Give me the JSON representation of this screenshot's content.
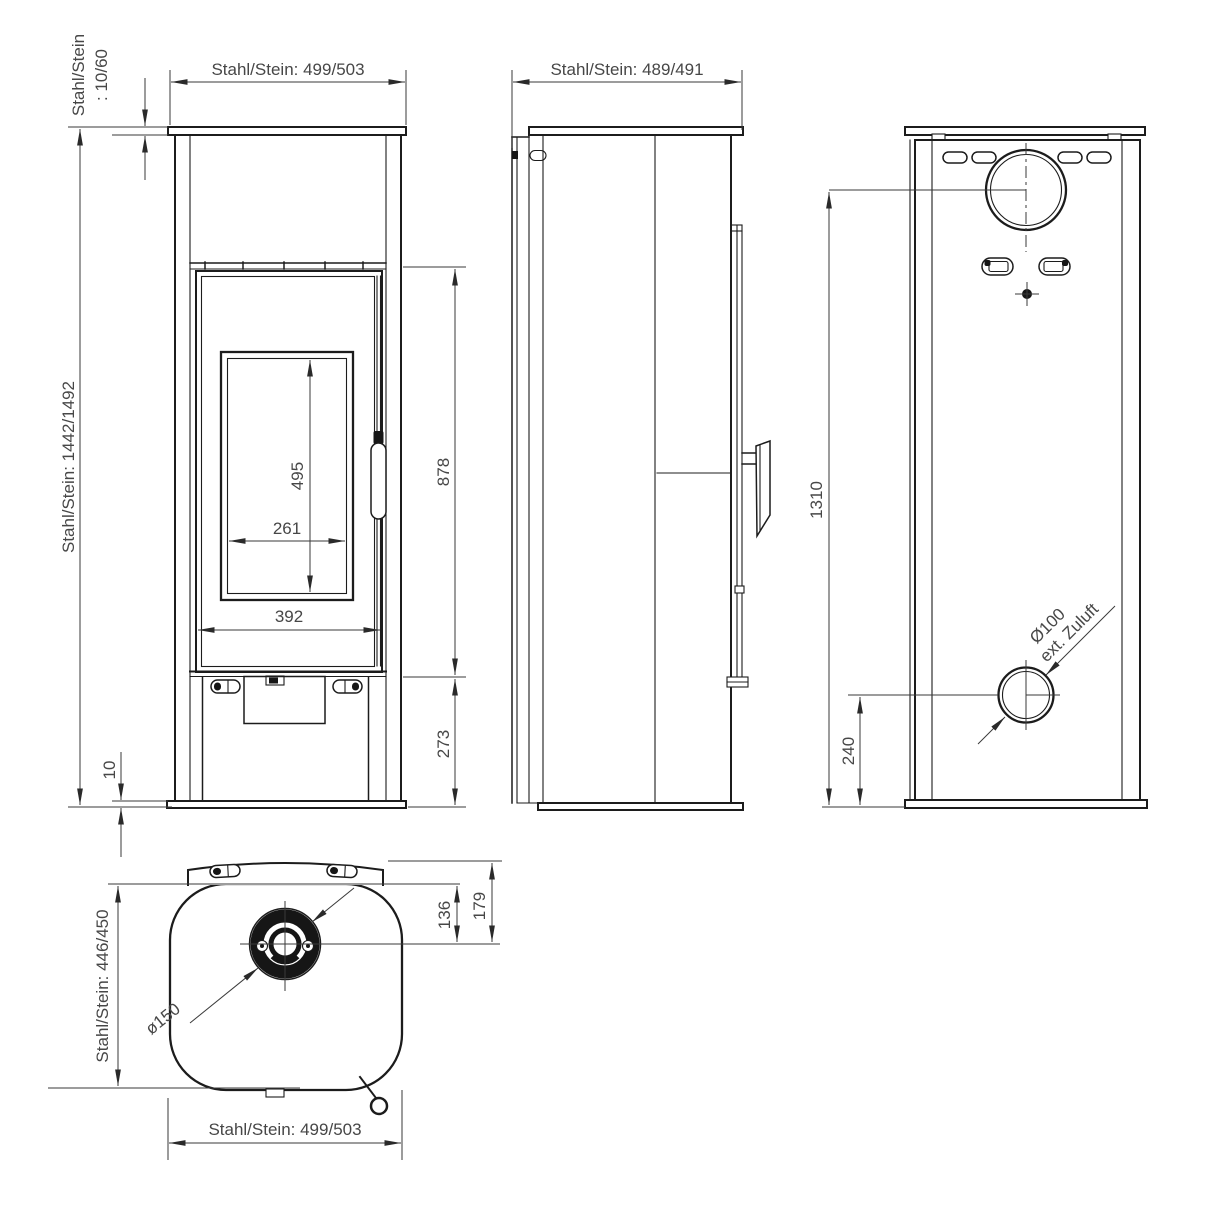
{
  "drawing": {
    "type": "technical-dimension-drawing",
    "subject": "wood stove (Kaminofen) four views",
    "colors": {
      "line": "#1c1c1c",
      "text": "#474747",
      "background": "#ffffff"
    },
    "views": {
      "front": {
        "width_label": "Stahl/Stein: 499/503",
        "height_label": "Stahl/Stein: 1442/1492",
        "plate_label_line1": "Stahl/Stein",
        "plate_label_line2": ": 10/60",
        "glass_height": "495",
        "glass_width": "261",
        "door_width": "392",
        "upper_height": "878",
        "base_height": "273",
        "bottom_clearance": "10"
      },
      "side": {
        "depth_label": "Stahl/Stein: 489/491"
      },
      "back": {
        "flue_center_height": "1310",
        "air_inlet_center_height": "240",
        "air_inlet_dia_line1": "Ø100",
        "air_inlet_dia_line2": "ext. Zuluft"
      },
      "top": {
        "depth_label": "Stahl/Stein: 446/450",
        "width_label": "Stahl/Stein: 499/503",
        "flue_offset_from_body": "136",
        "flue_offset_from_bar": "179",
        "flue_diameter": "ø150"
      }
    }
  }
}
